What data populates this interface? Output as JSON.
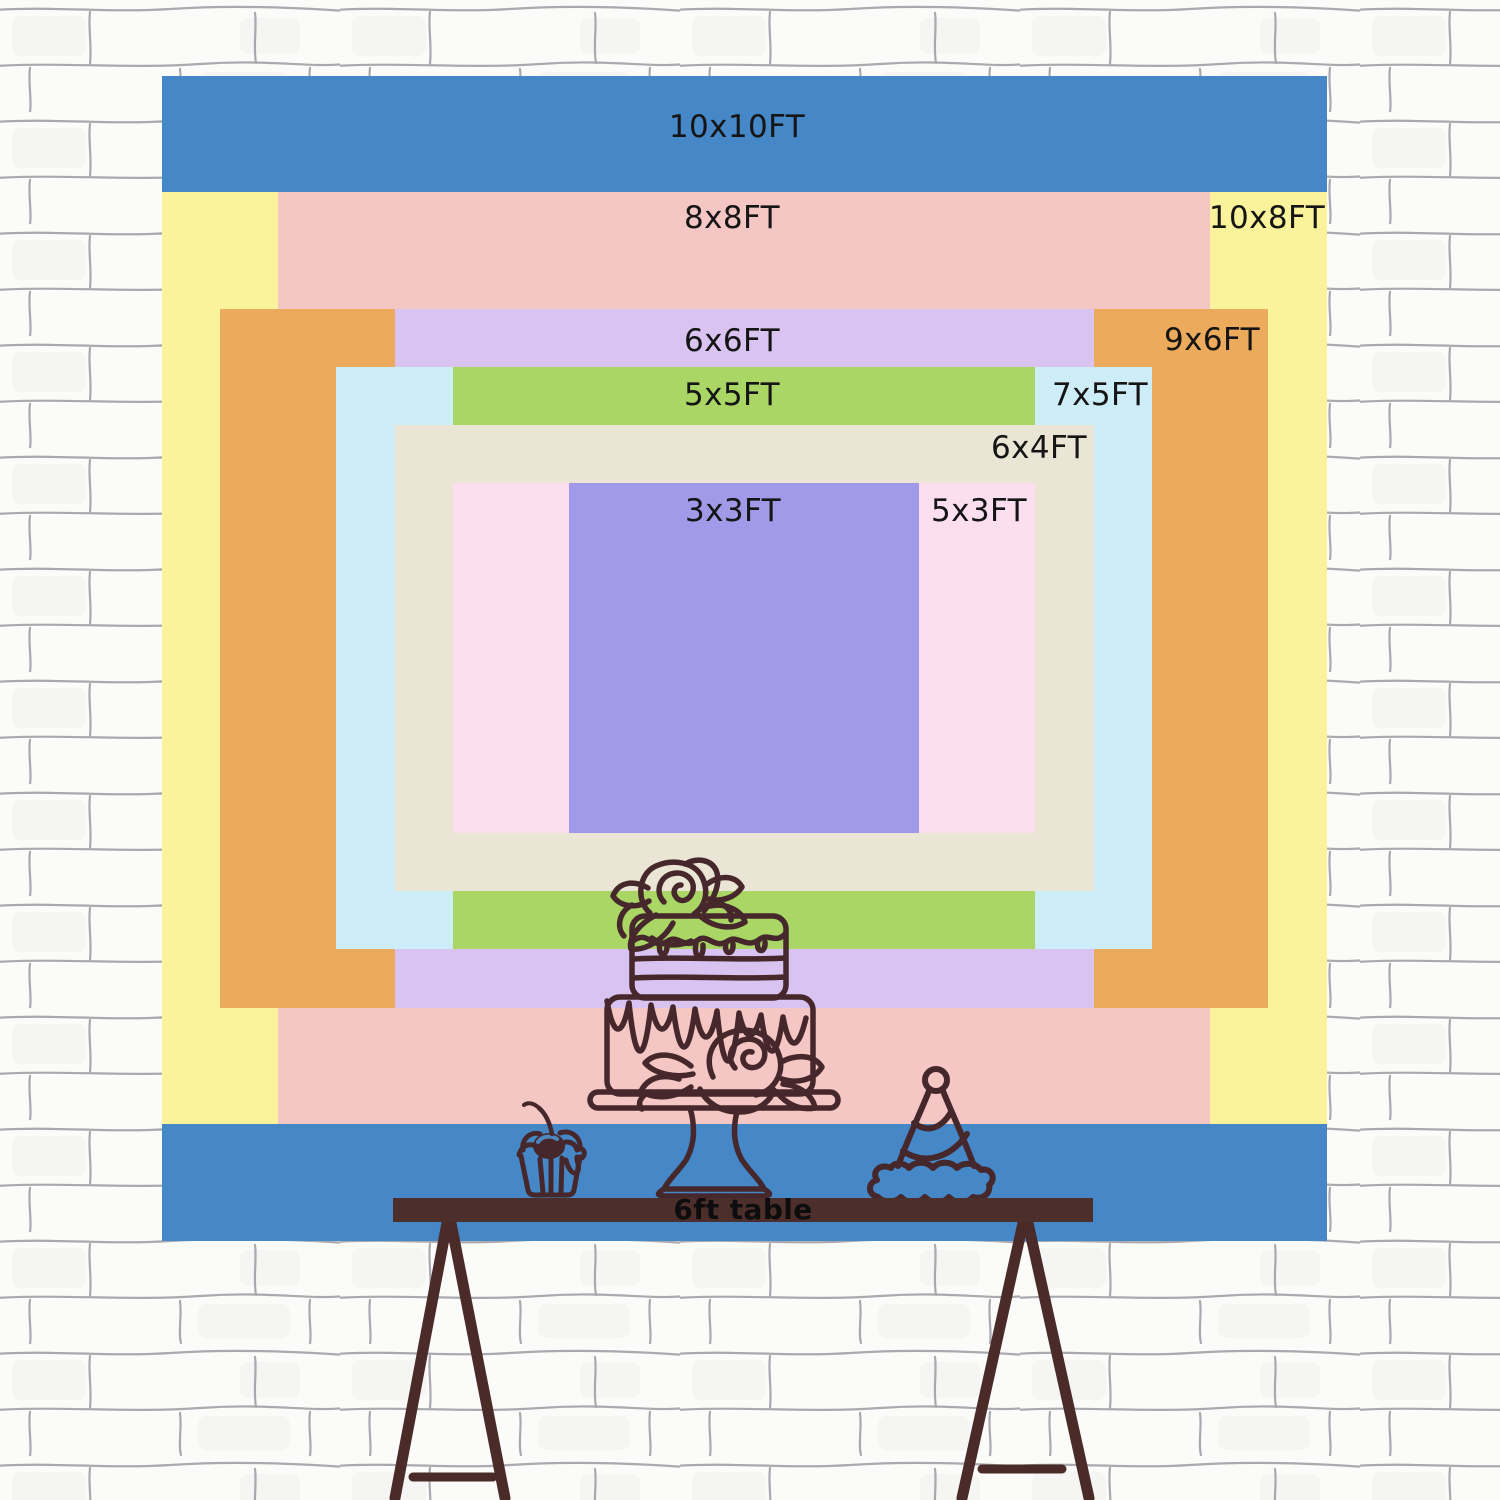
{
  "page": {
    "title": "Backdrop size comparison chart"
  },
  "wall": {
    "base_color": "#fbfbf9",
    "mortar_line_color": "#72727c"
  },
  "backdrop": {
    "center_x": 744,
    "center_y": 658,
    "px_per_ft": 116.5,
    "label_color": "#151515",
    "layers": [
      {
        "id": "10x10ft",
        "label": "10x10FT",
        "w_ft": 10,
        "h_ft": 10,
        "color": "#4587c7",
        "label_x": 737,
        "label_y": 127
      },
      {
        "id": "10x8ft",
        "label": "10x8FT",
        "w_ft": 10,
        "h_ft": 8,
        "color": "#fbf29c",
        "label_x": 1267,
        "label_y": 218
      },
      {
        "id": "8x8ft",
        "label": "8x8FT",
        "w_ft": 8,
        "h_ft": 8,
        "color": "#f5c7c4",
        "label_x": 732,
        "label_y": 218
      },
      {
        "id": "9x6ft",
        "label": "9x6FT",
        "w_ft": 9,
        "h_ft": 6,
        "color": "#ecab5c",
        "label_x": 1212,
        "label_y": 340
      },
      {
        "id": "6x6ft",
        "label": "6x6FT",
        "w_ft": 6,
        "h_ft": 6,
        "color": "#d9c3f1",
        "label_x": 732,
        "label_y": 341
      },
      {
        "id": "7x5ft",
        "label": "7x5FT",
        "w_ft": 7,
        "h_ft": 5,
        "color": "#cdedf9",
        "label_x": 1100,
        "label_y": 395
      },
      {
        "id": "5x5ft",
        "label": "5x5FT",
        "w_ft": 5,
        "h_ft": 5,
        "color": "#aad666",
        "label_x": 732,
        "label_y": 395
      },
      {
        "id": "6x4ft",
        "label": "6x4FT",
        "w_ft": 6,
        "h_ft": 4,
        "color": "#ebe5d5",
        "label_x": 1039,
        "label_y": 448
      },
      {
        "id": "5x3ft",
        "label": "5x3FT",
        "w_ft": 5,
        "h_ft": 3,
        "color": "#fcdef1",
        "label_x": 979,
        "label_y": 511
      },
      {
        "id": "3x3ft",
        "label": "3x3FT",
        "w_ft": 3,
        "h_ft": 3,
        "color": "#a09ae8",
        "label_x": 733,
        "label_y": 511
      }
    ]
  },
  "table": {
    "label": "6ft table",
    "color": "#4c2e2b",
    "width_ft": 6
  },
  "drawing_color": "#46282c",
  "chart_data": {
    "type": "table",
    "title": "Backdrop sizes (width x height, feet)",
    "sizes_ft": [
      {
        "label": "10x10FT",
        "w": 10,
        "h": 10
      },
      {
        "label": "10x8FT",
        "w": 10,
        "h": 8
      },
      {
        "label": "8x8FT",
        "w": 8,
        "h": 8
      },
      {
        "label": "9x6FT",
        "w": 9,
        "h": 6
      },
      {
        "label": "6x6FT",
        "w": 6,
        "h": 6
      },
      {
        "label": "7x5FT",
        "w": 7,
        "h": 5
      },
      {
        "label": "5x5FT",
        "w": 5,
        "h": 5
      },
      {
        "label": "6x4FT",
        "w": 6,
        "h": 4
      },
      {
        "label": "5x3FT",
        "w": 5,
        "h": 3
      },
      {
        "label": "3x3FT",
        "w": 3,
        "h": 3
      }
    ]
  }
}
